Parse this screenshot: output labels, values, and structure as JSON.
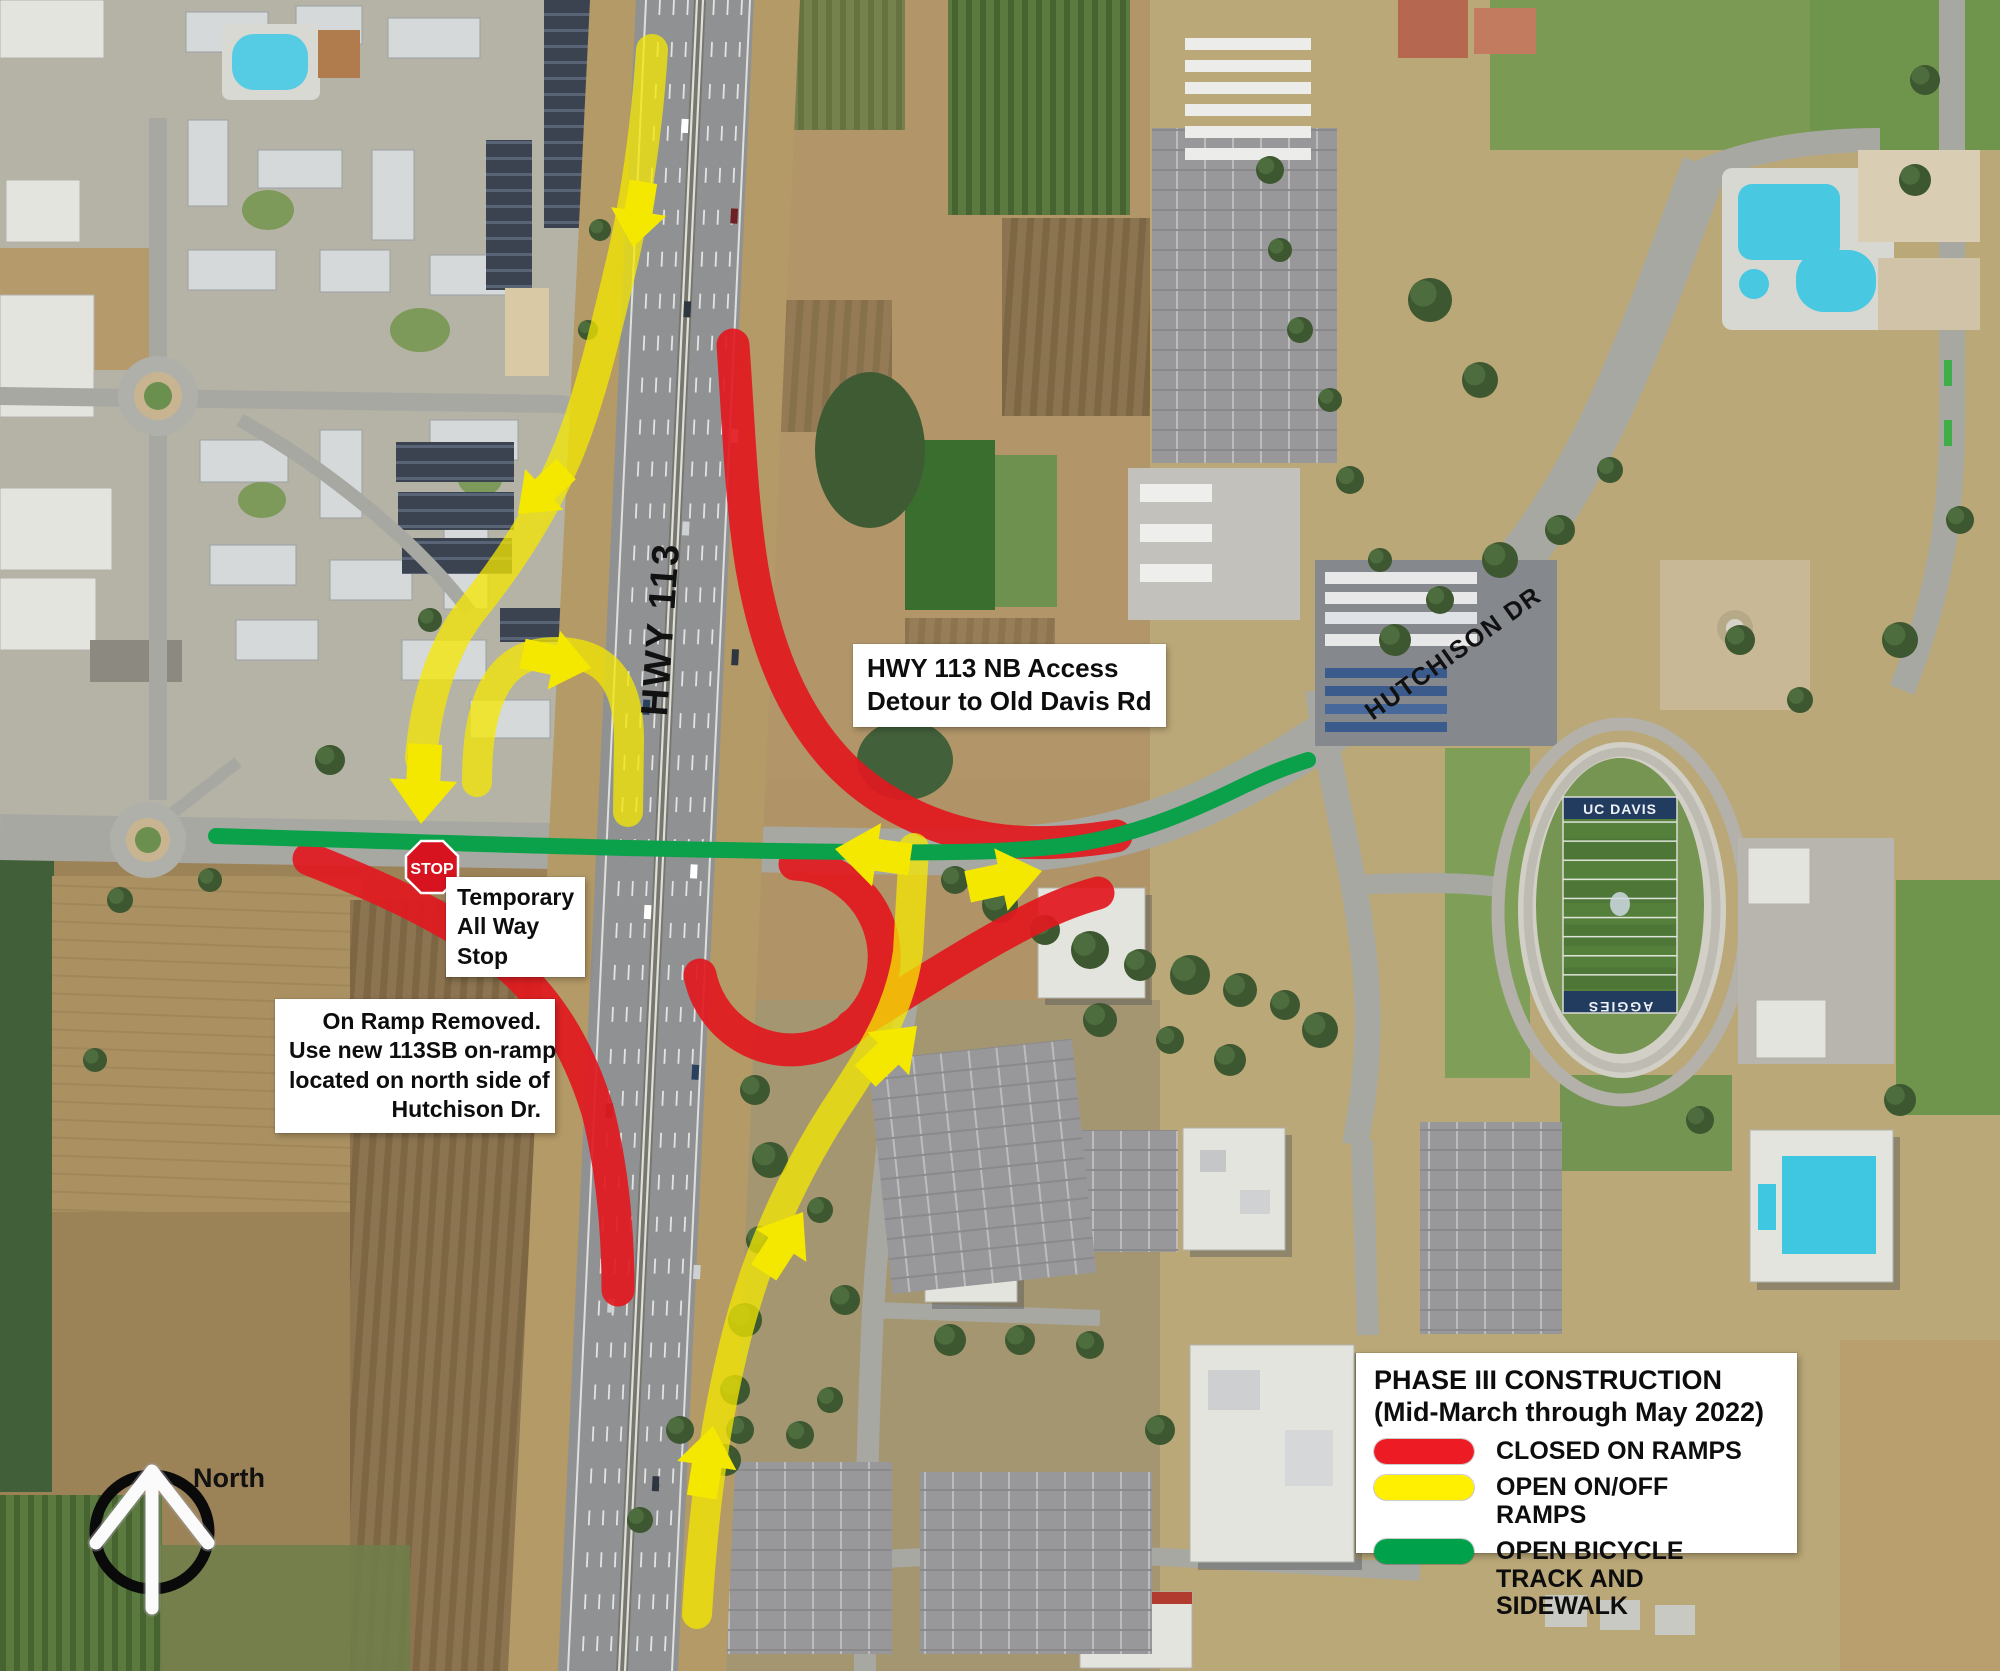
{
  "map": {
    "road_labels": [
      {
        "text": "HWY 113"
      },
      {
        "text": "HUTCHISON DR"
      }
    ],
    "stadium": {
      "end_zone_top": "UC DAVIS",
      "end_zone_bottom": "AGGIES"
    }
  },
  "annotations": {
    "detour_note": {
      "lines": [
        "HWY 113 NB Access",
        "Detour to Old Davis Rd"
      ]
    },
    "stop_note": {
      "lines": [
        "Temporary",
        "All Way",
        "Stop"
      ]
    },
    "onramp_note": {
      "lines": [
        "On Ramp Removed.",
        "Use new 113SB on-ramp",
        "located on north side of",
        "Hutchison Dr."
      ]
    },
    "stop_sign": {
      "text": "STOP"
    }
  },
  "compass": {
    "label": "North"
  },
  "legend": {
    "title_line1": "PHASE III CONSTRUCTION",
    "title_line2": "(Mid-March through May 2022)",
    "items": [
      {
        "label": "CLOSED ON RAMPS",
        "color": "#ed1c24"
      },
      {
        "label": "OPEN ON/OFF RAMPS",
        "color": "#ffef00"
      },
      {
        "label": "OPEN BICYCLE TRACK AND SIDEWALK",
        "color": "#00a14b"
      }
    ]
  },
  "overlay_colors": {
    "closed": "#e2191f",
    "open": "#f5e800",
    "bike": "#0aa14a"
  }
}
